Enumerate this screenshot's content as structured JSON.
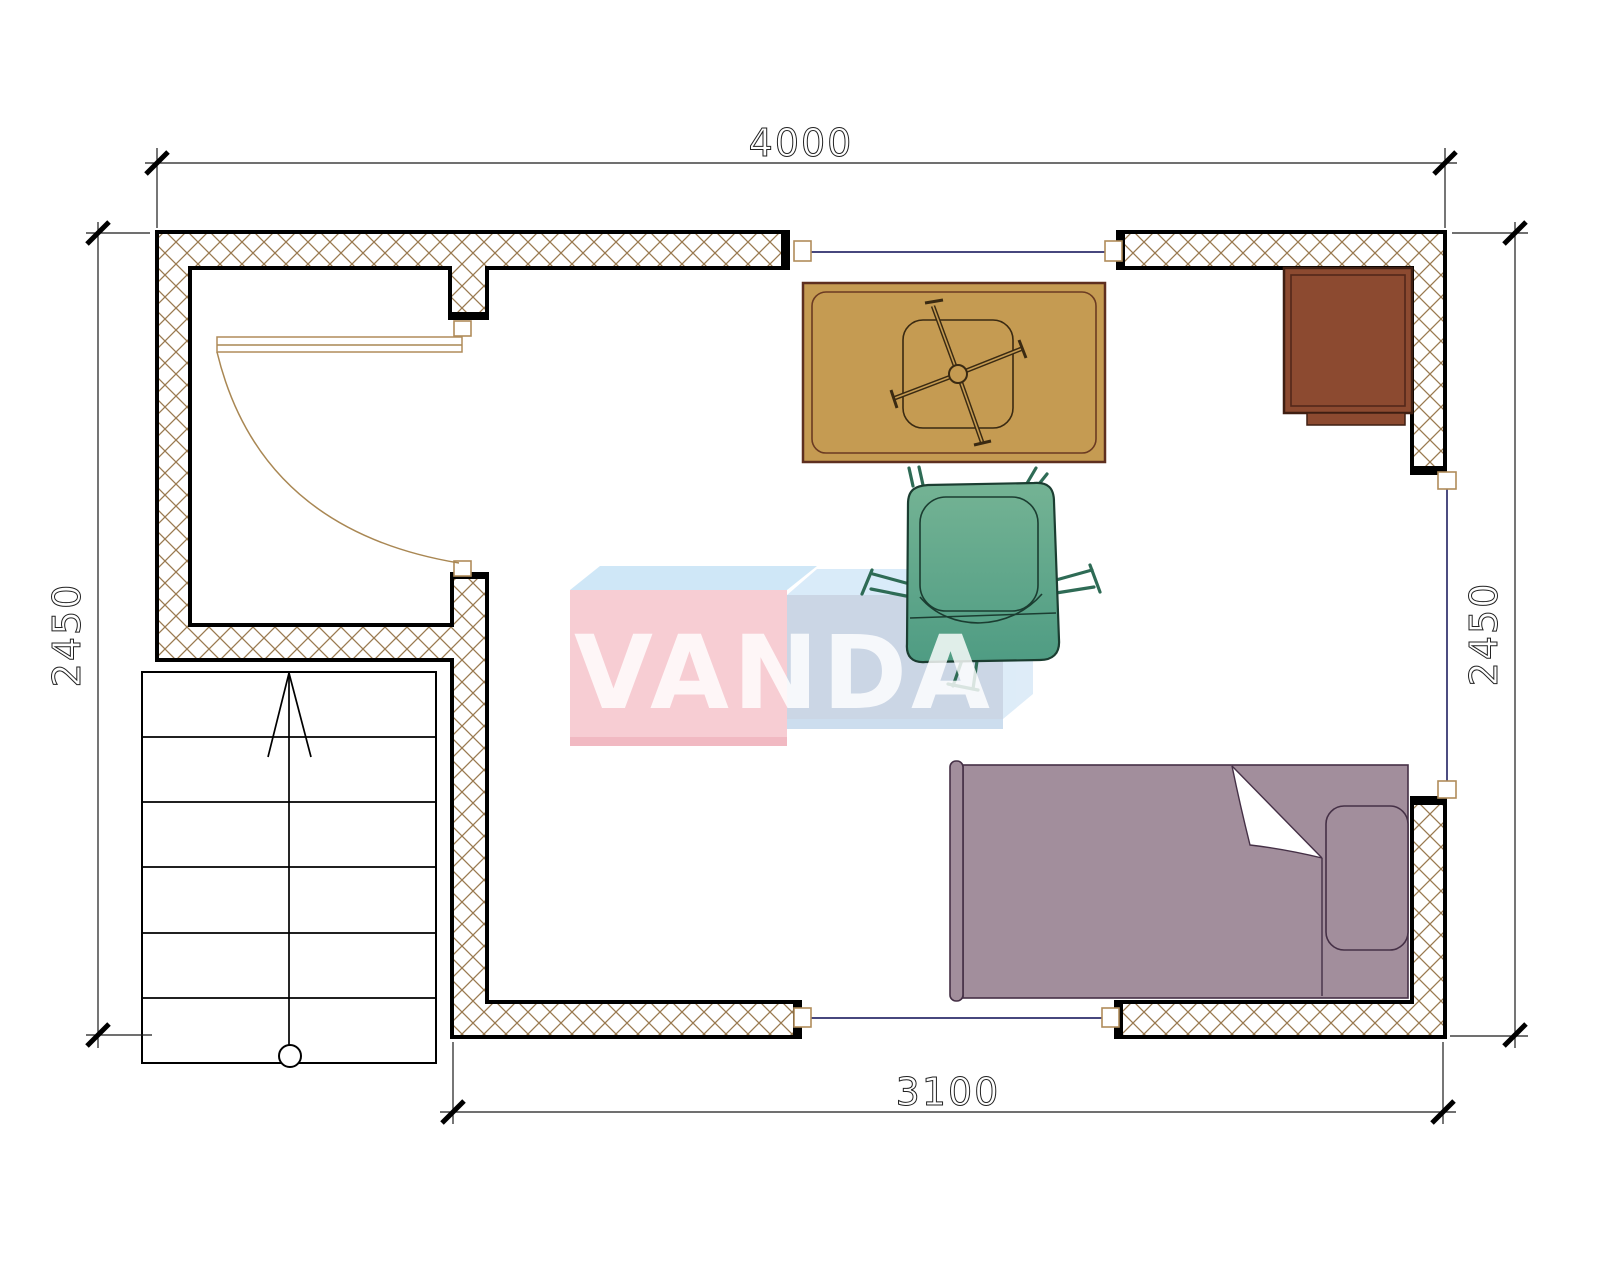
{
  "drawing": {
    "type": "floor-plan",
    "dimensions": {
      "top": "4000",
      "bottom": "3100",
      "left": "2450",
      "right": "2450"
    },
    "watermark": {
      "text": "VANDA"
    },
    "colors": {
      "wall_hatch": "#9a7a50",
      "wall_line": "#000000",
      "window_line": "#2d2d6b",
      "door_trim": "#b08c5a",
      "table_fill": "#c59b52",
      "table_outline": "#5e2f1f",
      "chair_fill": "#5ca78a",
      "chair_outline": "#1b3d31",
      "chair_leg": "#2e6b55",
      "bed_fill": "#a28e9c",
      "bed_outline": "#453046",
      "cabinet_fill": "#8c4a30",
      "cabinet_outline": "#3f1f12",
      "watermark_pink_front": "#f7cbd1",
      "watermark_pink_top": "#cde6f7",
      "watermark_blue_front": "#c9d4e4",
      "watermark_blue_top": "#d8eaf9",
      "watermark_blue_side": "#dcebf8",
      "watermark_text": "#ffffff"
    }
  }
}
